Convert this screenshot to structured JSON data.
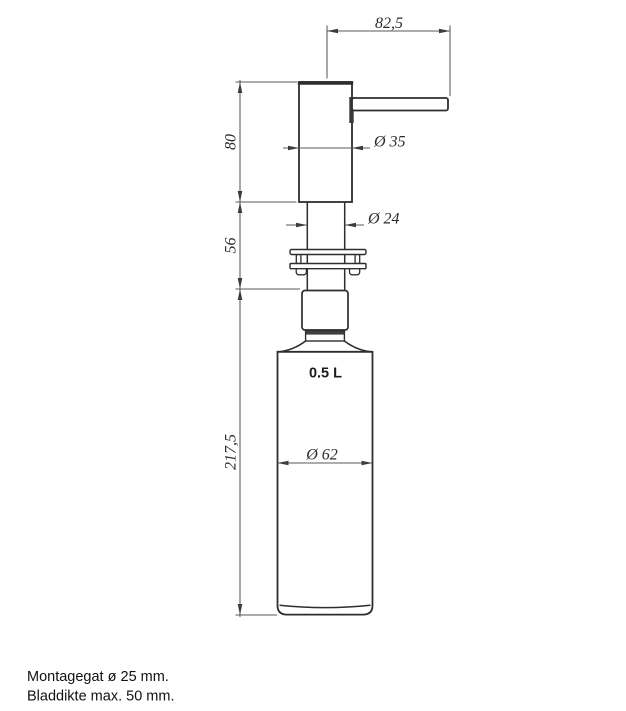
{
  "drawing": {
    "volume_label": "0.5 L",
    "dims": {
      "spout_reach": "82,5",
      "pump_height": "80",
      "stem_length": "56",
      "bottle_height": "217,5",
      "pump_diameter": "Ø 35",
      "stem_diameter": "Ø 24",
      "bottle_diameter": "Ø 62"
    },
    "notes": [
      "Montagegat ø 25 mm.",
      "Bladdikte max. 50 mm."
    ],
    "colors": {
      "outline": "#2e2e2e",
      "dimension_line": "#5a5a5a",
      "text": "#2b2b2b",
      "background": "#ffffff"
    }
  }
}
